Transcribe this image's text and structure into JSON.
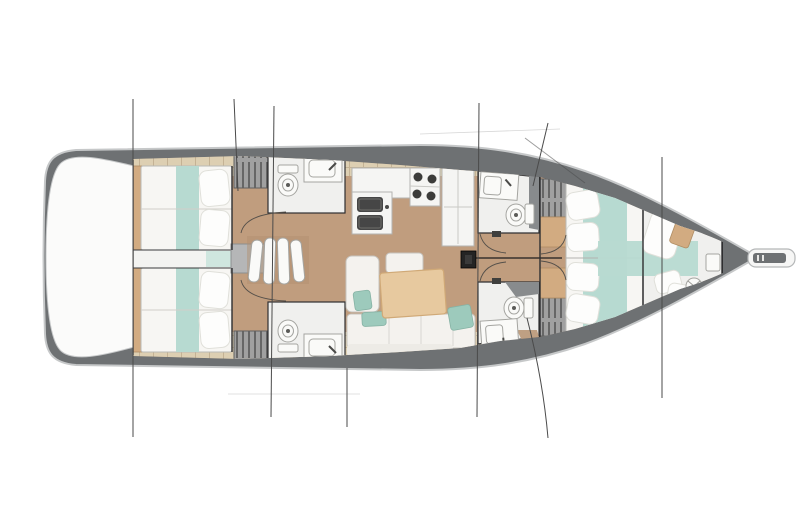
{
  "canvas": {
    "width": 800,
    "height": 505,
    "background": "#ffffff"
  },
  "diagram": {
    "subject": "sailing-yacht-interior-deck-plan",
    "orientation": "bow-right",
    "rooms": [
      "aft-cabin-port",
      "aft-cabin-starboard",
      "aft-head-port",
      "aft-head-starboard",
      "companionway-steps",
      "galley",
      "saloon",
      "forward-head-port",
      "forward-head-starboard",
      "forward-cabin",
      "bow-cabin"
    ],
    "fixtures": {
      "toilets": 4,
      "washbasins": 4,
      "galley_sinks": 2,
      "stove_burners": 4,
      "hanging_lockers": 4,
      "double_berths": 3,
      "bow_berths": 1,
      "saloon_table": 1,
      "mast": 1,
      "bowsprit": 1
    },
    "rig_lines": 9
  },
  "colors": {
    "background": "#ffffff",
    "hull_rim": "#6e7173",
    "hull_outline": "#c6c8c9",
    "transom_white": "#fbfbfa",
    "floor_tan": "#c09d7e",
    "deck_beige": "#ddcfb2",
    "plank_seam": "#c4b294",
    "locker_gray": "#a0a0a0",
    "locker_stroke": "#606060",
    "hanger_dark": "#4e4e4e",
    "room_floor": "#f0f0ee",
    "room_border": "#2f2f31",
    "fixture_white": "#fafaf8",
    "fixture_stroke": "#a5a5a1",
    "teal": "#b7dad1",
    "teal_light": "#cfe6df",
    "teal_cushion": "#9dcabc",
    "mattress": "#f7f6f3",
    "pillow": "#fdfdfc",
    "pillow_stroke": "#e0e0da",
    "headboard_tan": "#d2ab81",
    "table_tan": "#e7c99f",
    "table_stroke": "#d0a977",
    "sofa": "#f4f2ee",
    "sofa_stroke": "#c6c4bf",
    "counter_white": "#f5f5f3",
    "sink_dark": "#464646",
    "wedge_gray": "#888b8d",
    "wedge_tan": "#bfa083",
    "mast_black": "#242424",
    "rig_line": "#4a4a4a",
    "door_arc": "#55504a"
  }
}
